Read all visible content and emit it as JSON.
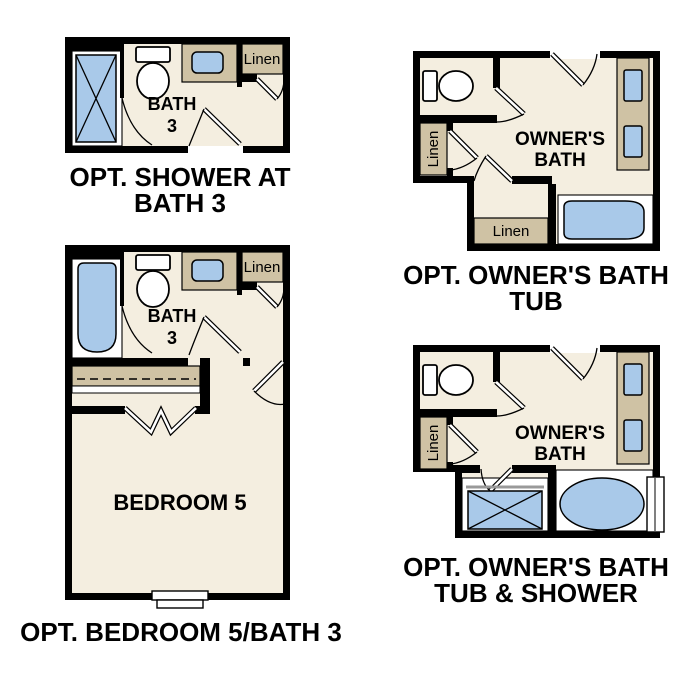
{
  "colors": {
    "background": "#ffffff",
    "wall": "#000000",
    "floor": "#f4eee0",
    "fixture": "#a9c9e9",
    "cabinet": "#cfc2a4",
    "text": "#000000"
  },
  "plans": {
    "bath3_shower": {
      "caption1": "OPT. SHOWER AT",
      "caption2": "BATH 3",
      "room1": "BATH",
      "room2": "3",
      "linen": "Linen",
      "fixtures": [
        "shower",
        "toilet",
        "vanity-sink",
        "linen-closet"
      ]
    },
    "owners_bath_tub": {
      "caption1": "OPT. OWNER'S BATH",
      "caption2": "TUB",
      "room1": "OWNER'S",
      "room2": "BATH",
      "linen_side": "Linen",
      "linen_bottom": "Linen",
      "fixtures": [
        "toilet",
        "double-vanity",
        "bathtub",
        "linen-closet-side",
        "linen-closet-bottom"
      ]
    },
    "bedroom5_bath3": {
      "caption": "OPT. BEDROOM 5/BATH 3",
      "room1": "BATH",
      "room2": "3",
      "bedroom": "BEDROOM 5",
      "linen": "Linen",
      "fixtures": [
        "bathtub",
        "toilet",
        "vanity-sink",
        "linen-closet",
        "closet-shelf",
        "bifold-doors",
        "window"
      ]
    },
    "owners_bath_tub_shower": {
      "caption1": "OPT. OWNER'S BATH",
      "caption2": "TUB & SHOWER",
      "room1": "OWNER'S",
      "room2": "BATH",
      "linen_side": "Linen",
      "fixtures": [
        "toilet",
        "double-vanity",
        "shower",
        "oval-bathtub",
        "linen-closet-side",
        "window"
      ]
    }
  }
}
